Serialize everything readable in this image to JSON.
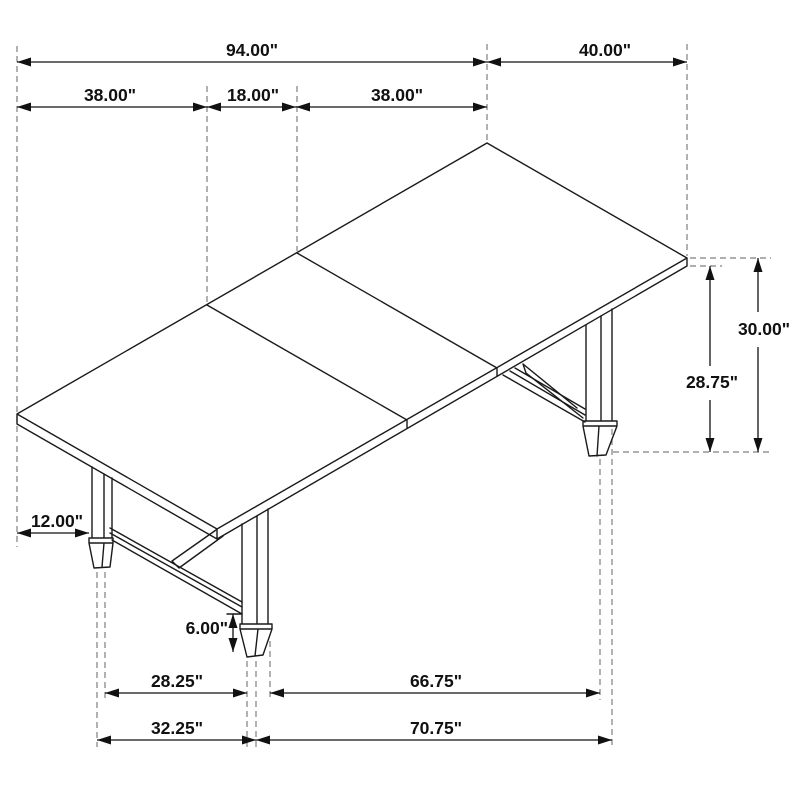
{
  "dims": {
    "w94": "94.00\"",
    "w40": "40.00\"",
    "w38a": "38.00\"",
    "w18": "18.00\"",
    "w38b": "38.00\"",
    "h30": "30.00\"",
    "h2875": "28.75\"",
    "w12": "12.00\"",
    "h6": "6.00\"",
    "w2825": "28.25\"",
    "w6675": "66.75\"",
    "w3225": "32.25\"",
    "w7075": "70.75\""
  }
}
